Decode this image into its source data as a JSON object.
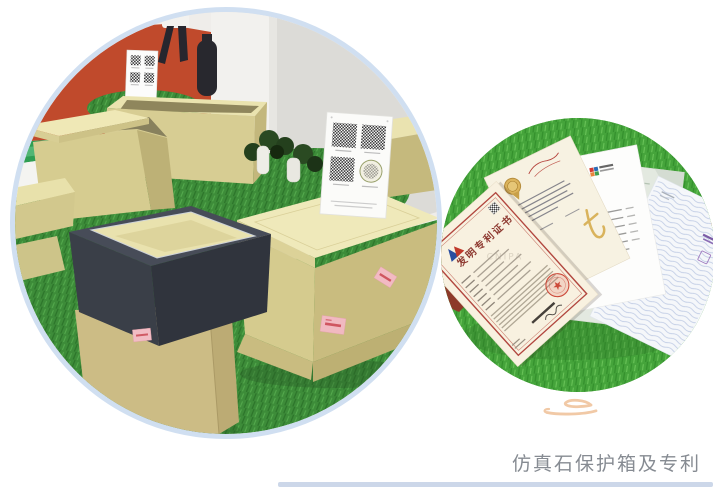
{
  "caption": {
    "text": "仿真石保护箱及专利"
  },
  "right_photo": {
    "patent": {
      "title": "发明专利证书",
      "watermark": "CNIPA"
    }
  },
  "colors": {
    "circle_ring": "#d0dff1",
    "divider": "#ccd7e9",
    "cloud": "#f1c9a6",
    "caption_text": "#868b92",
    "orange_wall": "#c04a2c",
    "grass_left": "#3d8c39",
    "grass_right": "#45a43b",
    "box_beige": "#d7cd93",
    "box_charcoal": "#3a3f48",
    "patent_border_red": "#b2473f",
    "seal_red": "#cc4a3a",
    "medal_gold": "#dcb45c",
    "label_pink": "#f2bac3"
  },
  "icons": {
    "qr_code_icon": "dark checkerboard square",
    "round_stamp_icon": "olive ring stamp",
    "seal_icon": "red circle with star",
    "medal_icon": "gold medallion",
    "pct_badge_icon": "red oval badge",
    "cloud_icon": "peach calligraphic swoosh"
  }
}
